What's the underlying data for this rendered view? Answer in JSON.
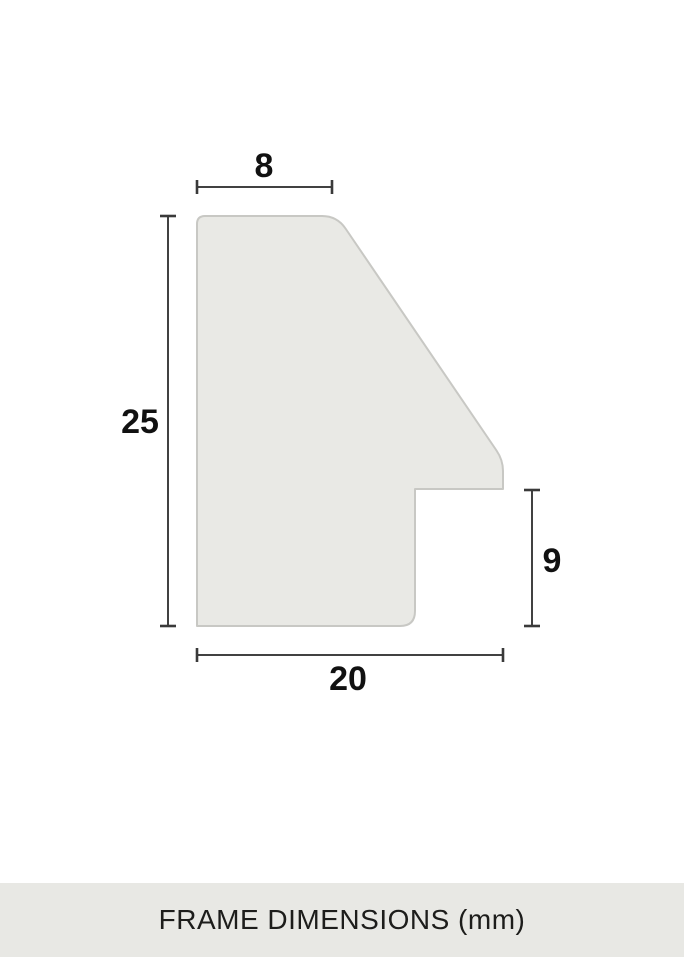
{
  "diagram": {
    "description": "Cross-section profile of a picture frame moulding with dimension lines",
    "dimensions": {
      "top_width": {
        "value": "8"
      },
      "height": {
        "value": "25"
      },
      "rabbet_height": {
        "value": "9"
      },
      "bottom_width": {
        "value": "20"
      }
    }
  },
  "footer": {
    "title": "FRAME DIMENSIONS (mm)"
  },
  "colors": {
    "page_background": "#ffffff",
    "shape_fill": "#e9e9e5",
    "shape_stroke": "#c8c8c4",
    "dimension_line": "#414141",
    "label_text": "#111111",
    "footer_background": "#e8e8e4",
    "footer_text": "#1d1d1b"
  }
}
